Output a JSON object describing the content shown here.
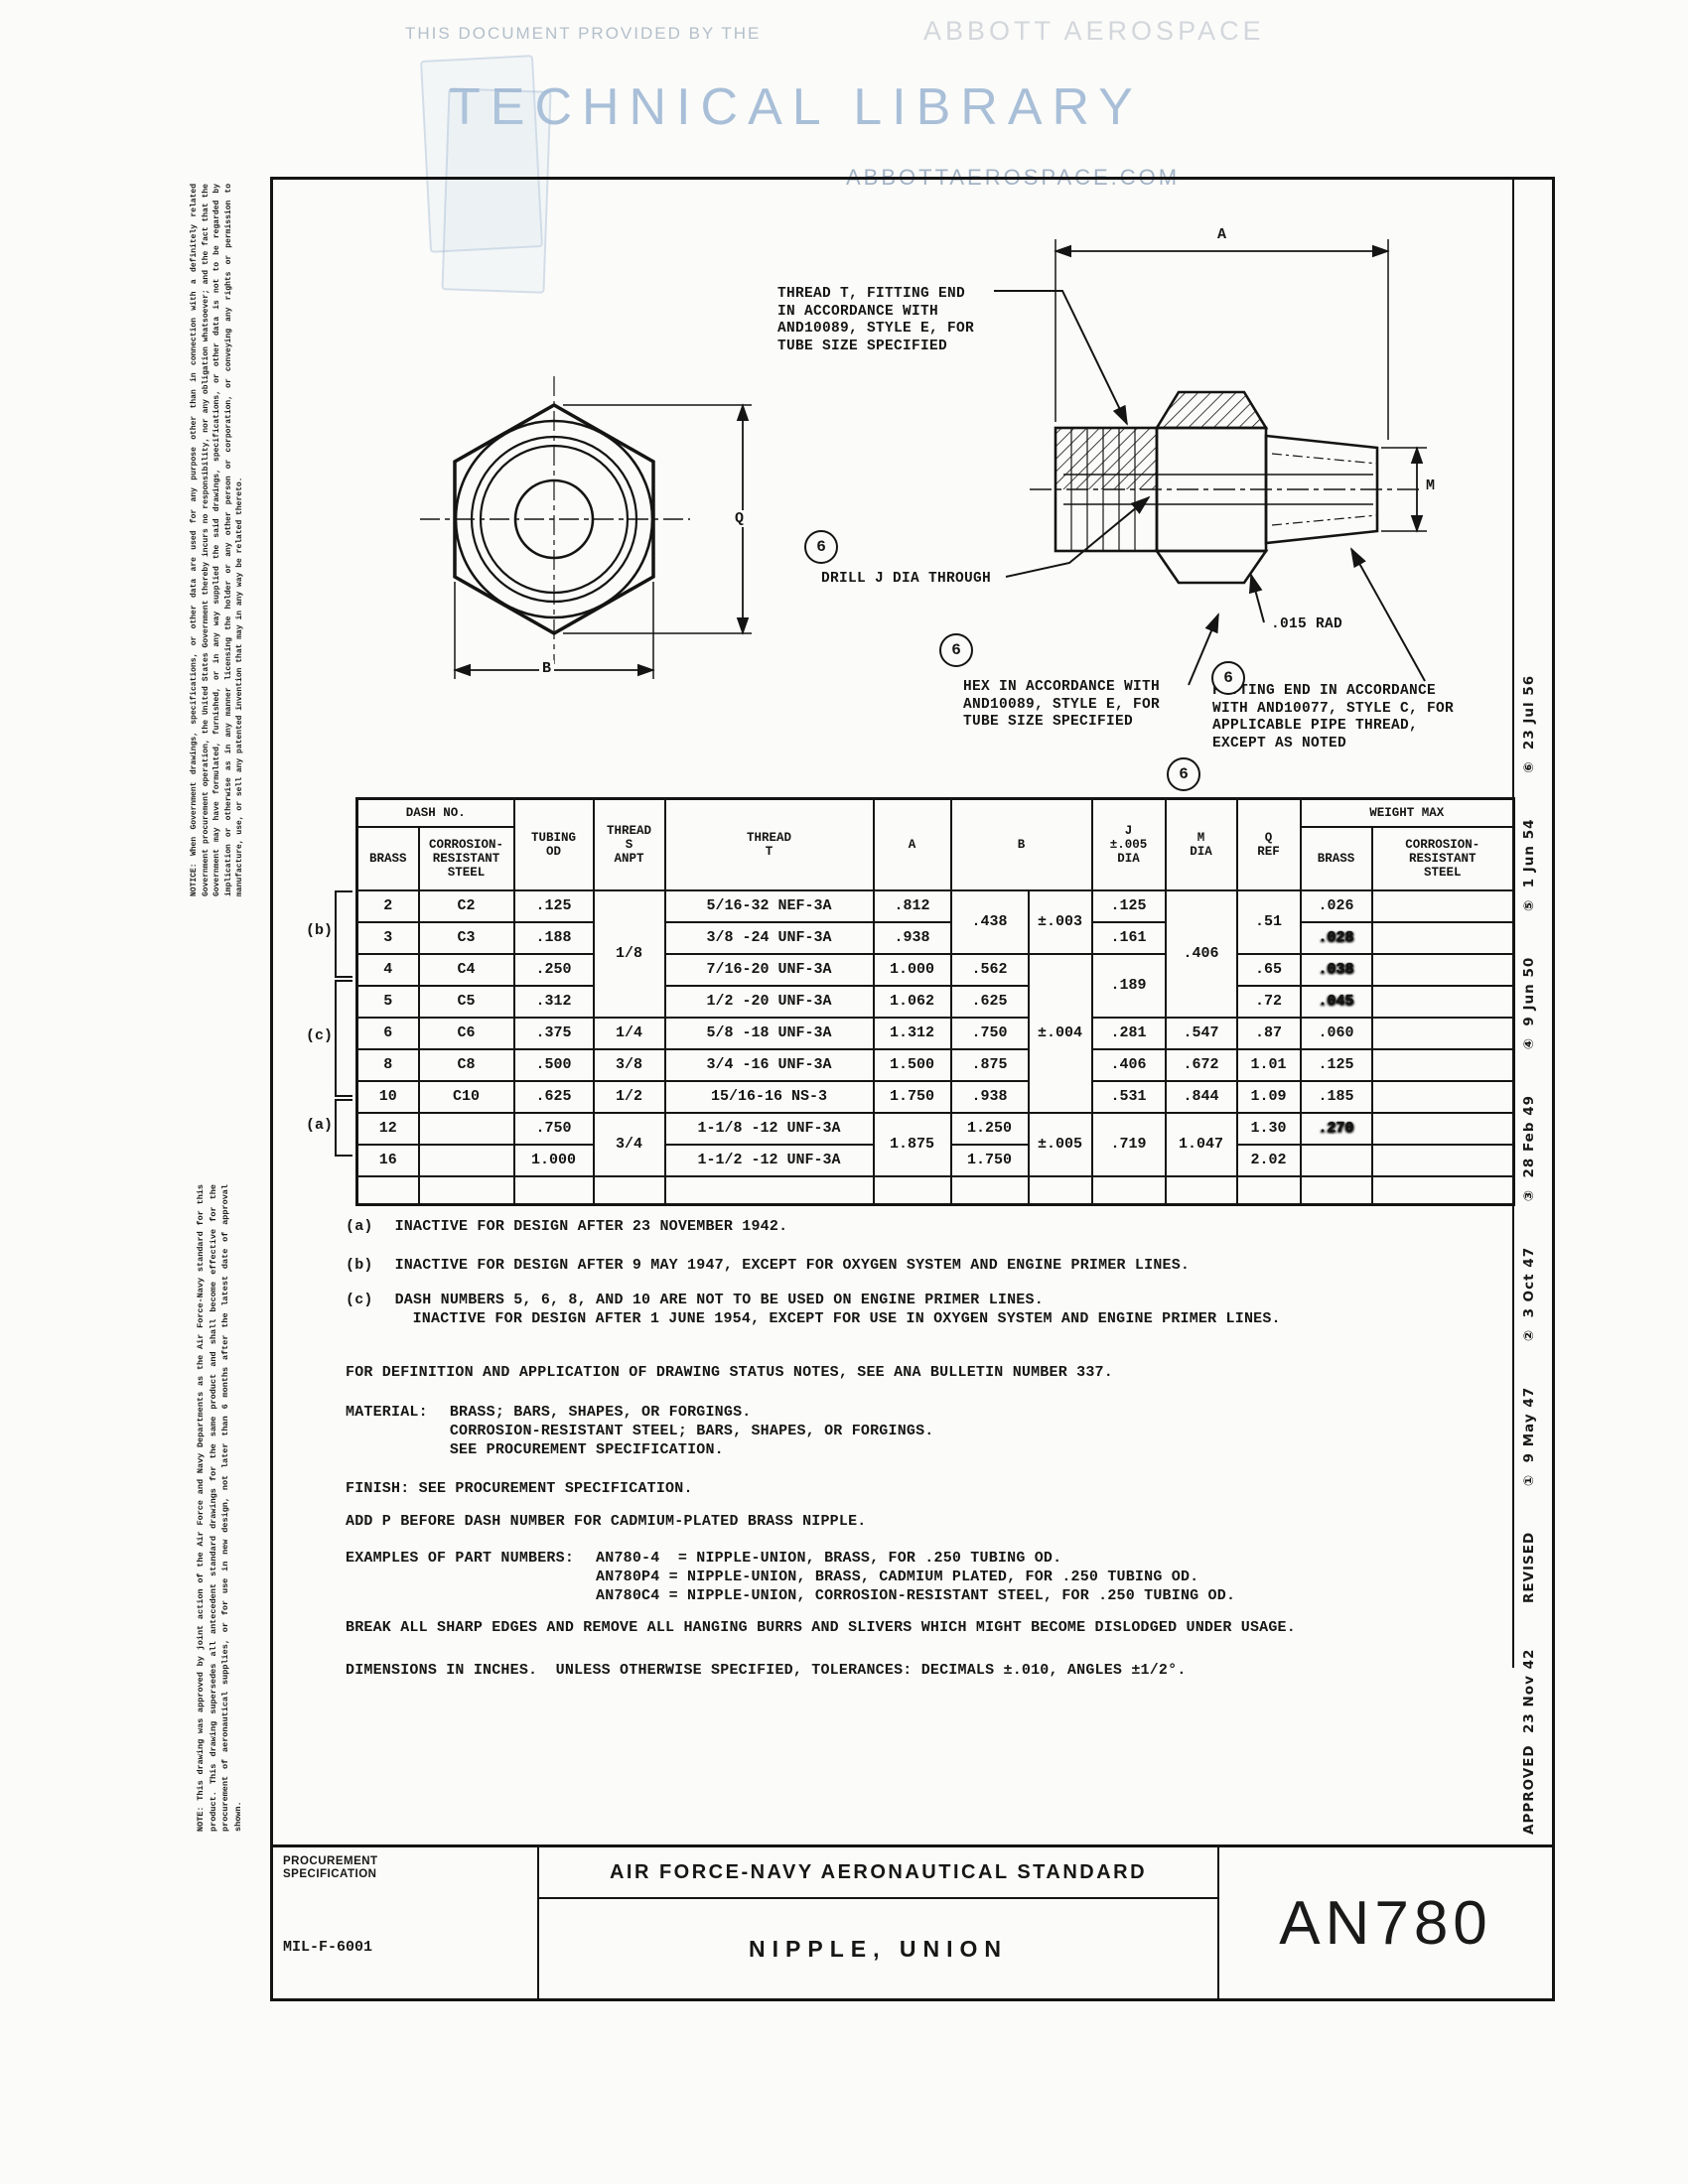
{
  "watermark": {
    "provided": "THIS DOCUMENT PROVIDED BY THE",
    "brand": "ABBOTT AEROSPACE",
    "library": "TECHNICAL LIBRARY",
    "url": "ABBOTTAEROSPACE.COM",
    "accent_color": "#a9bfd8"
  },
  "margins": {
    "disclaimer": "NOTICE: When Government drawings, specifications, or other data are used for any purpose other than in connection with a definitely related Government procurement operation, the United States Government thereby incurs no responsibility, nor any obligation whatsoever; and the fact that the Government may have formulated, furnished, or in any way supplied the said drawings, specifications, or other data is not to be regarded by implication or otherwise as in any manner licensing the holder or any other person or corporation, or conveying any rights or permission to manufacture, use, or sell any patented invention that may in any way be related thereto.",
    "approval_note": "NOTE: This drawing was approved by joint action of the Air Force and Navy Departments as the Air Force-Navy standard for this product.  This drawing supersedes all antecedent standard drawings for the same product and shall become effective for the procurement of aeronautical supplies, or for use in new design, not later than 6 months after the latest date of approval shown.",
    "revisions": "APPROVED  23 Nov 42        REVISED        ①  9 May 47        ②  3 Oct 47        ③  28 Feb 49        ④  9 Jun 50        ⑤  1 Jun 54        ⑥  23 Jul 56"
  },
  "drawing": {
    "balloon": "6",
    "callouts": {
      "thread_t": "THREAD T, FITTING END\nIN ACCORDANCE WITH\nAND10089, STYLE E, FOR\nTUBE SIZE SPECIFIED",
      "drill": "DRILL J DIA THROUGH",
      "hex": "HEX IN ACCORDANCE WITH\nAND10089, STYLE E, FOR\nTUBE SIZE SPECIFIED",
      "rad": ".015 RAD",
      "fitting_end": "FITTING END IN ACCORDANCE\nWITH AND10077, STYLE C, FOR\nAPPLICABLE PIPE THREAD,\nEXCEPT AS NOTED"
    },
    "dims": {
      "a": "A",
      "b": "B",
      "q": "Q",
      "m": "M"
    }
  },
  "table": {
    "header": {
      "dash_no": "DASH NO.",
      "brass": "BRASS",
      "crs": "CORROSION-\nRESISTANT\nSTEEL",
      "tubing_od": "TUBING\nOD",
      "thread_s": "THREAD\nS\nANPT",
      "thread_t": "THREAD\nT",
      "a": "A",
      "b": "B",
      "j": "J\n±.005\nDIA",
      "m": "M\nDIA",
      "q": "Q\nREF",
      "weight_max": "WEIGHT MAX",
      "w_brass": "BRASS",
      "w_crs": "CORROSION-\nRESISTANT\nSTEEL"
    },
    "brackets": {
      "b": "(b)",
      "c": "(c)",
      "a": "(a)"
    },
    "spans": {
      "thread_s_18": "1/8",
      "thread_s_34": "3/4",
      "b_438": ".438",
      "tol_003": "±.003",
      "tol_004": "±.004",
      "tol_005": "±.005",
      "j_189": ".189",
      "m_406": ".406",
      "q_51": ".51",
      "a_1875": "1.875",
      "j_719": ".719",
      "m_1047": "1.047"
    },
    "rows": {
      "r2": {
        "brass": "2",
        "crs": "C2",
        "od": ".125",
        "tt": "5/16-32 NEF-3A",
        "a": ".812",
        "j": ".125",
        "wb": ".026"
      },
      "r3": {
        "brass": "3",
        "crs": "C3",
        "od": ".188",
        "tt": "3/8 -24 UNF-3A",
        "a": ".938",
        "j": ".161",
        "wb": ".028"
      },
      "r4": {
        "brass": "4",
        "crs": "C4",
        "od": ".250",
        "tt": "7/16-20 UNF-3A",
        "a": "1.000",
        "b": ".562",
        "q": ".65",
        "wb": ".038"
      },
      "r5": {
        "brass": "5",
        "crs": "C5",
        "od": ".312",
        "tt": "1/2 -20 UNF-3A",
        "a": "1.062",
        "b": ".625",
        "q": ".72",
        "wb": ".045"
      },
      "r6": {
        "brass": "6",
        "crs": "C6",
        "od": ".375",
        "ts": "1/4",
        "tt": "5/8 -18 UNF-3A",
        "a": "1.312",
        "b": ".750",
        "j": ".281",
        "m": ".547",
        "q": ".87",
        "wb": ".060"
      },
      "r8": {
        "brass": "8",
        "crs": "C8",
        "od": ".500",
        "ts": "3/8",
        "tt": "3/4 -16 UNF-3A",
        "a": "1.500",
        "b": ".875",
        "j": ".406",
        "m": ".672",
        "q": "1.01",
        "wb": ".125"
      },
      "r10": {
        "brass": "10",
        "crs": "C10",
        "od": ".625",
        "ts": "1/2",
        "tt": "15/16-16 NS-3",
        "a": "1.750",
        "b": ".938",
        "j": ".531",
        "m": ".844",
        "q": "1.09",
        "wb": ".185"
      },
      "r12": {
        "brass": "12",
        "crs": "",
        "od": ".750",
        "tt": "1-1/8 -12 UNF-3A",
        "b": "1.250",
        "q": "1.30",
        "wb": ".270"
      },
      "r16": {
        "brass": "16",
        "crs": "",
        "od": "1.000",
        "tt": "1-1/2 -12 UNF-3A",
        "b": "1.750",
        "q": "2.02",
        "wb": ""
      }
    }
  },
  "notes": {
    "a_label": "(a)",
    "a_text": "INACTIVE FOR DESIGN AFTER 23 NOVEMBER 1942.",
    "b_label": "(b)",
    "b_text": "INACTIVE FOR DESIGN AFTER 9 MAY 1947, EXCEPT FOR OXYGEN SYSTEM AND ENGINE PRIMER LINES.",
    "c_label": "(c)",
    "c_line1": "DASH NUMBERS 5, 6, 8, AND 10 ARE NOT TO BE USED ON ENGINE PRIMER LINES.",
    "c_line2": "INACTIVE FOR DESIGN AFTER 1 JUNE 1954, EXCEPT FOR USE IN OXYGEN SYSTEM AND ENGINE PRIMER LINES.",
    "status": "FOR DEFINITION AND APPLICATION OF DRAWING STATUS NOTES, SEE ANA BULLETIN NUMBER 337.",
    "material_label": "MATERIAL:",
    "material_1": "BRASS; BARS, SHAPES, OR FORGINGS.",
    "material_2": "CORROSION-RESISTANT STEEL; BARS, SHAPES, OR FORGINGS.",
    "material_3": "SEE PROCUREMENT SPECIFICATION.",
    "finish": "FINISH: SEE PROCUREMENT SPECIFICATION.",
    "cadmium": "ADD P BEFORE DASH NUMBER FOR CADMIUM-PLATED BRASS NIPPLE.",
    "examples_label": "EXAMPLES OF PART NUMBERS:",
    "example_1": "AN780-4  = NIPPLE-UNION, BRASS, FOR .250 TUBING OD.",
    "example_2": "AN780P4 = NIPPLE-UNION, BRASS, CADMIUM PLATED, FOR .250 TUBING OD.",
    "example_3": "AN780C4 = NIPPLE-UNION, CORROSION-RESISTANT STEEL, FOR .250 TUBING OD.",
    "deburr": "BREAK ALL SHARP EDGES AND REMOVE ALL HANGING BURRS AND SLIVERS WHICH MIGHT BECOME DISLODGED UNDER USAGE.",
    "dimensions": "DIMENSIONS IN INCHES.  UNLESS OTHERWISE SPECIFIED, TOLERANCES: DECIMALS ±.010, ANGLES ±1/2°."
  },
  "title_block": {
    "proc_spec_label": "PROCUREMENT\nSPECIFICATION",
    "proc_spec_value": "MIL-F-6001",
    "standard_title": "AIR FORCE-NAVY AERONAUTICAL STANDARD",
    "part_title": "NIPPLE, UNION",
    "standard_number": "AN780"
  }
}
